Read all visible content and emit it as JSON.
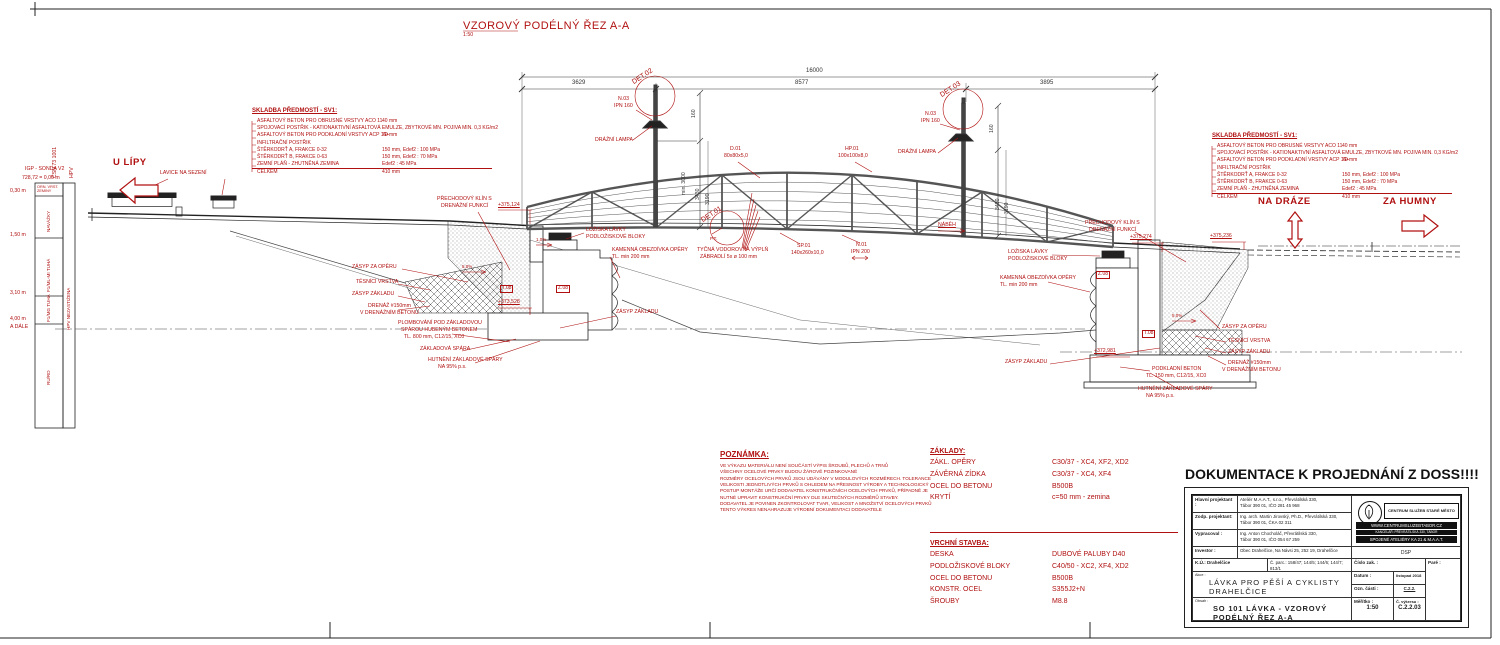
{
  "drawing_title": {
    "text": "VZOROVÝ PODÉLNÝ ŘEZ A-A",
    "scale": "1:50"
  },
  "direction_labels": {
    "u_lipy": "U LÍPY",
    "na_draze": "NA DRÁZE",
    "za_humny": "ZA HUMNY"
  },
  "borehole": {
    "name": "IGP - SONDA V2",
    "datum": "728,72 = 0,00 m",
    "col_headers": [
      "ČSN 73 1001",
      "HPV"
    ],
    "depths": [
      "0,30 m",
      "1,50 m",
      "3,10 m",
      "4,00 m",
      "A DÁLE"
    ],
    "layers": [
      "ORN. VRST. ZEMINY",
      "NAVÁŽKY",
      "F1/ML-MI TUHÁ",
      "F1/MG TUHÁ",
      "RU/RD"
    ],
    "note": "HPV NEZASTIŽENA"
  },
  "pavement": {
    "heading": "SKLADBA PŘEDMOSTÍ - SV1:",
    "rows": [
      {
        "label": "ASFALTOVÝ BETON PRO OBRUSNÉ VRSTVY ACO 11",
        "value": "40 mm"
      },
      {
        "label": "SPOJOVACÍ POSTŘIK - KATIONAKTIVNÍ ASFALTOVÁ EMULZE, ZBYTKOVÉ MN. POJIVA MIN. 0,3 KG/m2",
        "value": ""
      },
      {
        "label": "ASFALTOVÝ BETON PRO PODKLADNÍ VRSTVY ACP 16+",
        "value": "70 mm"
      },
      {
        "label": "INFILTRAČNÍ POSTŘIK",
        "value": ""
      },
      {
        "label": "ŠTĚRKODRŤ A, FRAKCE 0-32",
        "value": "150 mm, Edef2 : 100 MPa"
      },
      {
        "label": "ŠTĚRKODRŤ B, FRAKCE 0-63",
        "value": "150 mm, Edef2 : 70 MPa"
      },
      {
        "label": "ZEMNÍ PLÁŇ - ZHUTNĚNÁ ZEMINA",
        "value": "Edef2 : 45 MPa"
      },
      {
        "label": "CELKEM",
        "value": "410 mm"
      }
    ]
  },
  "dimensions": {
    "total": "16000",
    "seg1": "3629",
    "seg2": "8577",
    "seg3": "3895",
    "v160": "160",
    "v3430": "3430",
    "v3190": "3190",
    "vmin": "min. 3000"
  },
  "details": {
    "det01": "DET.01",
    "det02": "DET.02",
    "det03": "DET.03"
  },
  "members": {
    "lamp_post_1": "N.03",
    "lamp_post_2": "IPN 160",
    "lamp": "DRÁŽNÍ LAMPA",
    "diag_1": "D.01",
    "diag_2": "80x80x5,0",
    "top_chord_1": "HP.01",
    "top_chord_2": "100x100x8,0",
    "bottom_chord_1": "SP.01",
    "bottom_chord_2": "140x260x10,0",
    "cross_beam_1": "N.01",
    "cross_beam_2": "IPN 200",
    "railing_1": "TYČNÁ VODOROVNÁ VÝPLŇ",
    "railing_2": "ZÁBRADLÍ 5x ø 100 mm",
    "nabeh": "NÁBĚH",
    "pt": "P.T."
  },
  "abutment": {
    "klin_1": "PŘECHODOVÝ KLÍN S",
    "klin_2": "DRENÁŽNÍ FUNKCÍ",
    "loziska": "LOŽISKA LÁVKY",
    "bloky": "PODLOŽISKOVÉ BLOKY",
    "obezdivka_1": "KAMENNÁ OBEZDÍVKA OPĚRY",
    "obezdivka_2": "TL. min 200 mm",
    "zasyp_operu": "ZÁSYP ZA OPĚRU",
    "tesnici": "TĚSNÍCÍ VRSTVA",
    "zasyp_zakladu": "ZÁSYP ZÁKLADU",
    "drenaz_1": "DRENÁŽ #150mm",
    "drenaz_2": "V DRENÁŽNÍM BETONU",
    "plomba_1": "PLOMBOVÁNÍ POD ZÁKLADOVOU",
    "plomba_2": "SPÁROU HUBENÝM BETONEM",
    "plomba_3": "TL. 800 mm, C12/15, XC0",
    "spara": "ZÁKLADOVÁ SPÁRA",
    "hutneni_1": "HUTNĚNÍ ZÁKLADOVÉ SPÁRY",
    "hutneni_2": "NA 95% p.s.",
    "podkladni_1": "PODKLADNÍ BETON",
    "podkladni_2": "TL. 150 mm, C12/15, XC0",
    "lavice": "LAVICE NA SEZENÍ",
    "slope5": "5,0%",
    "slope1": "1,0%",
    "code_t": "T.08",
    "code_z": "Z.08"
  },
  "elevations": {
    "left_top": "+375,124",
    "left_base": "+373,528",
    "right_back": "+375,274",
    "right_top": "+375,236",
    "right_base": "+372,981"
  },
  "notes": {
    "heading": "POZNÁMKA:",
    "lines": [
      "VE VÝKAZU MATERIÁLU NENÍ SOUČÁSTÍ VÝPIS ŠROUBŮ, PLECHŮ A TRNŮ",
      "VŠECHNY OCELOVÉ PRVKY BUDOU ŽÁROVĚ POZINKOVANÉ",
      "ROZMĚRY OCELOVÝCH PRVKŮ JSOU UDÁVÁNY V MODULOVÝCH ROZMĚRECH. TOLERANCE",
      "VELIKOSTI JEDNOTLIVÝCH PRVKŮ S OHLEDEM NA PŘESNOST VÝROBY A TECHNOLOGICKÝ",
      "POSTUP MONTÁŽE URČÍ DODAVATEL KONSTRUKČNÍCH OCELOVÝCH PRVKŮ, PŘÍPADNĚ JE",
      "NUTNÉ UPRAVIT KONSTRUKČNÍ PRVKY DLE SKUTEČNÝCH ROZMĚRŮ STAVBY.",
      "DODAVATEL JE POVINEN ZKONTROLOVAT TVAR, VELIKOST A MNOŽSTVÍ OCELOVÝCH PRVKŮ",
      "TENTO VÝKRES NENAHRAZUJE VÝROBNÍ DOKUMENTACI DODAVATELE"
    ]
  },
  "foundations_table": {
    "heading": "ZÁKLADY:",
    "rows": [
      {
        "label": "ZÁKL. OPĚRY",
        "value": "C30/37 - XC4, XF2, XD2"
      },
      {
        "label": "ZÁVĚRNÁ ZÍDKA",
        "value": "C30/37 - XC4, XF4"
      },
      {
        "label": "OCEL DO BETONU",
        "value": "B500B"
      },
      {
        "label": "KRYTÍ",
        "value": "c=50 mm - zemina"
      }
    ]
  },
  "superstructure_table": {
    "heading": "VRCHNÍ STAVBA:",
    "rows": [
      {
        "label": "DESKA",
        "value": "DUBOVÉ PALUBY D40"
      },
      {
        "label": "PODLOŽISKOVÉ BLOKY",
        "value": "C40/50 - XC2, XF4, XD2"
      },
      {
        "label": "OCEL DO BETONU",
        "value": "B500B"
      },
      {
        "label": "KONSTR. OCEL",
        "value": "S355J2+N"
      },
      {
        "label": "ŠROUBY",
        "value": "M8.8"
      }
    ]
  },
  "stamp": {
    "banner": "DOKUMENTACE K PROJEDNÁNÍ Z DOSS!!!!",
    "rows": [
      {
        "label": "Hlavní projektant :",
        "line1": "Ateliér M.A.A.T., s.r.o., Převrátilská 330,",
        "line2": "Tábor 390 01, IČO 281 45 968"
      },
      {
        "label": "Zodp. projektant:",
        "line1": "Ing. arch. Martin Jirovský, Ph.D., Převrátilská 330,",
        "line2": "Tábor 390 01, ČKA 02 311"
      },
      {
        "label": "Vypracoval :",
        "line1": "Ing. Anton Chocholáč, Převrátilská 330,",
        "line2": "Tábor 390 01, IČO 054 67 259"
      },
      {
        "label": "Investor :",
        "line1": "Obec Drahelčice, Na Návsi 25, 252 19, Drahelčice",
        "line2": ""
      }
    ],
    "logo_title": "CENTRUM SLUŽEB STARÉ MĚSTO",
    "logo_bar1": "WWW.CENTRUMSLUZEBTABOR.CZ",
    "logo_bar2": "KANCELÁŘ: PŘEVRÁTILSKÁ 330, TÁBOR",
    "logo_bar3": "SPOJENÉ ATELIÉRY KA 21 & M.A.A.T.",
    "stage": "DSP",
    "ku": "K.Ú.: Drahelčice",
    "parcels": "Č. parc.: 158/47; 144/5; 144/6; 144/7; 813/1",
    "cislo_zak": "Číslo zak. :",
    "pare": "Paré :",
    "akce_label": "Akce :",
    "akce_1": "LÁVKA PRO PĚŠÍ A CYKLISTY",
    "akce_2": "DRAHELČICE",
    "datum_label": "Datum :",
    "datum": "listopad 2018",
    "ozn_label": "Ozn. části :",
    "ozn": "C.2.2.",
    "obsah_label": "Obsah :",
    "obsah_1": "SO 101 LÁVKA - VZOROVÝ",
    "obsah_2": "PODÉLNÝ ŘEZ A-A",
    "meritko_label": "Měřítko :",
    "meritko": "1:50",
    "vykres_label": "Č. výkresu :",
    "vykres": "C.2.2.03"
  },
  "colors": {
    "annotation_red": "#b01010",
    "line_black": "#222222"
  }
}
